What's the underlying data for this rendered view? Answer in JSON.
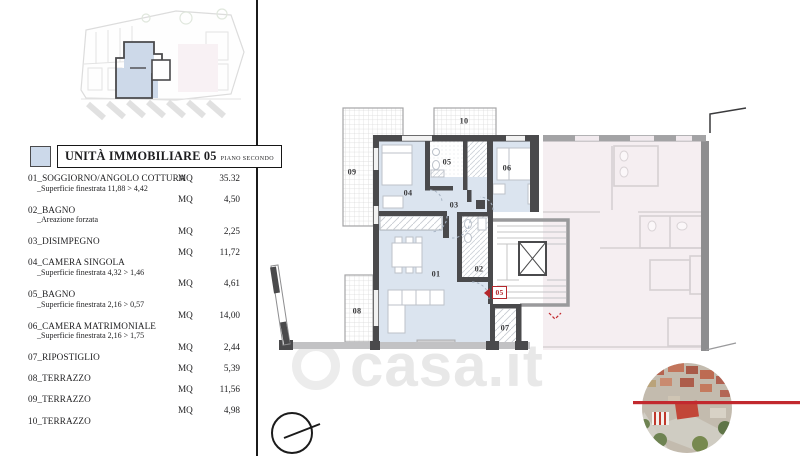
{
  "panel": {
    "title": "UNITÀ IMMOBILIARE 05",
    "title_suffix": "PIANO SECONDO",
    "unit_label": "MQ",
    "swatch_color": "#ccd9ea",
    "rows": [
      {
        "name": "01_SOGGIORNO/ANGOLO COTTURA",
        "sub": "_Superficie finestrata 11,88 > 4,42",
        "value": "35.32"
      },
      {
        "name": "02_BAGNO",
        "sub": "_Areazione forzata",
        "value": "4,50"
      },
      {
        "name": "03_DISIMPEGNO",
        "sub": "",
        "value": "2,25"
      },
      {
        "name": "04_CAMERA SINGOLA",
        "sub": "_Superficie finestrata 4,32 > 1,46",
        "value": "11,72"
      },
      {
        "name": "05_BAGNO",
        "sub": "_Superficie finestrata 2,16 > 0,57",
        "value": "4,61"
      },
      {
        "name": "06_CAMERA MATRIMONIALE",
        "sub": "_Superficie finestrata 2,16 > 1,75",
        "value": "14,00"
      },
      {
        "name": "07_RIPOSTIGLIO",
        "sub": "",
        "value": "2,44"
      },
      {
        "name": "08_TERRAZZO",
        "sub": "",
        "value": "5,39"
      },
      {
        "name": "09_TERRAZZO",
        "sub": "",
        "value": "11,56"
      },
      {
        "name": "10_TERRAZZO",
        "sub": "",
        "value": "4,98"
      }
    ]
  },
  "plan": {
    "room_labels": [
      "01",
      "02",
      "03",
      "04",
      "05",
      "06",
      "07",
      "08",
      "09",
      "10"
    ],
    "entrance_badge": "05",
    "colors": {
      "unit_fill": "#dbe4ef",
      "adjacent_fill": "#f5eef1",
      "wall": "#4a4a4c",
      "accent_red": "#c2292e"
    }
  },
  "watermark": {
    "text": "casa.it"
  }
}
